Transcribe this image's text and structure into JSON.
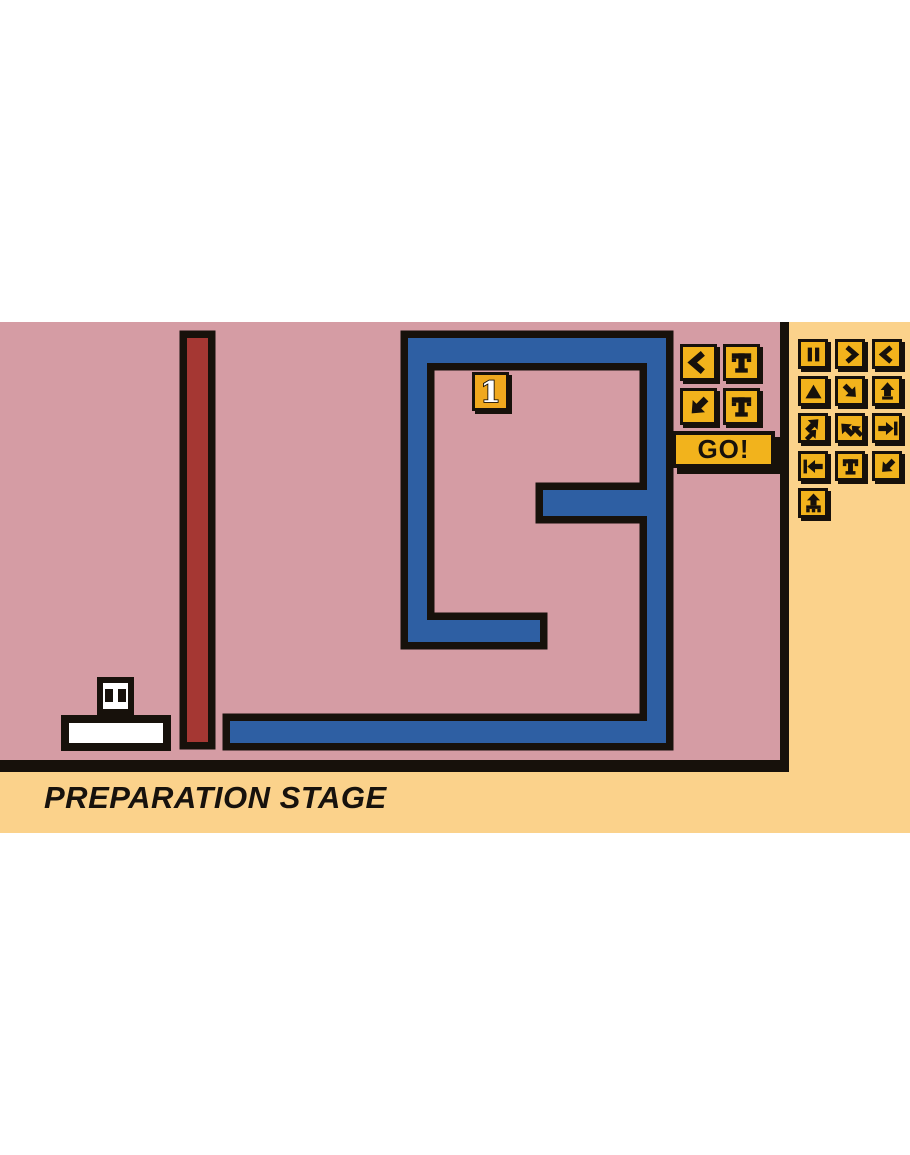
{
  "stage": {
    "title": "PREPARATION STAGE",
    "level_badge": "1"
  },
  "colors": {
    "field_pink": "#d59ca4",
    "backdrop_yellow": "#fbd28b",
    "button_yellow": "#f2b31c",
    "badge_orange": "#f0a81e",
    "wall_blue": "#2e5fa3",
    "wall_red": "#a53733",
    "outline_black": "#17110b"
  },
  "program_panel": {
    "buttons": [
      {
        "icon": "chevron-left"
      },
      {
        "icon": "letter-t",
        "label": "T"
      },
      {
        "icon": "cursor-sw"
      },
      {
        "icon": "letter-t",
        "label": "T"
      }
    ],
    "go_label": "GO!"
  },
  "command_palette": {
    "buttons": [
      {
        "icon": "pause"
      },
      {
        "icon": "chevron-right"
      },
      {
        "icon": "chevron-left"
      },
      {
        "icon": "triangle-up"
      },
      {
        "icon": "cursor-se"
      },
      {
        "icon": "arrow-up-tail"
      },
      {
        "icon": "double-arrow-ne"
      },
      {
        "icon": "double-arrow-nw"
      },
      {
        "icon": "arrow-right-bar"
      },
      {
        "icon": "arrow-left-bar"
      },
      {
        "icon": "letter-t",
        "label": "T"
      },
      {
        "icon": "cursor-sw"
      },
      {
        "icon": "signpost"
      }
    ]
  }
}
